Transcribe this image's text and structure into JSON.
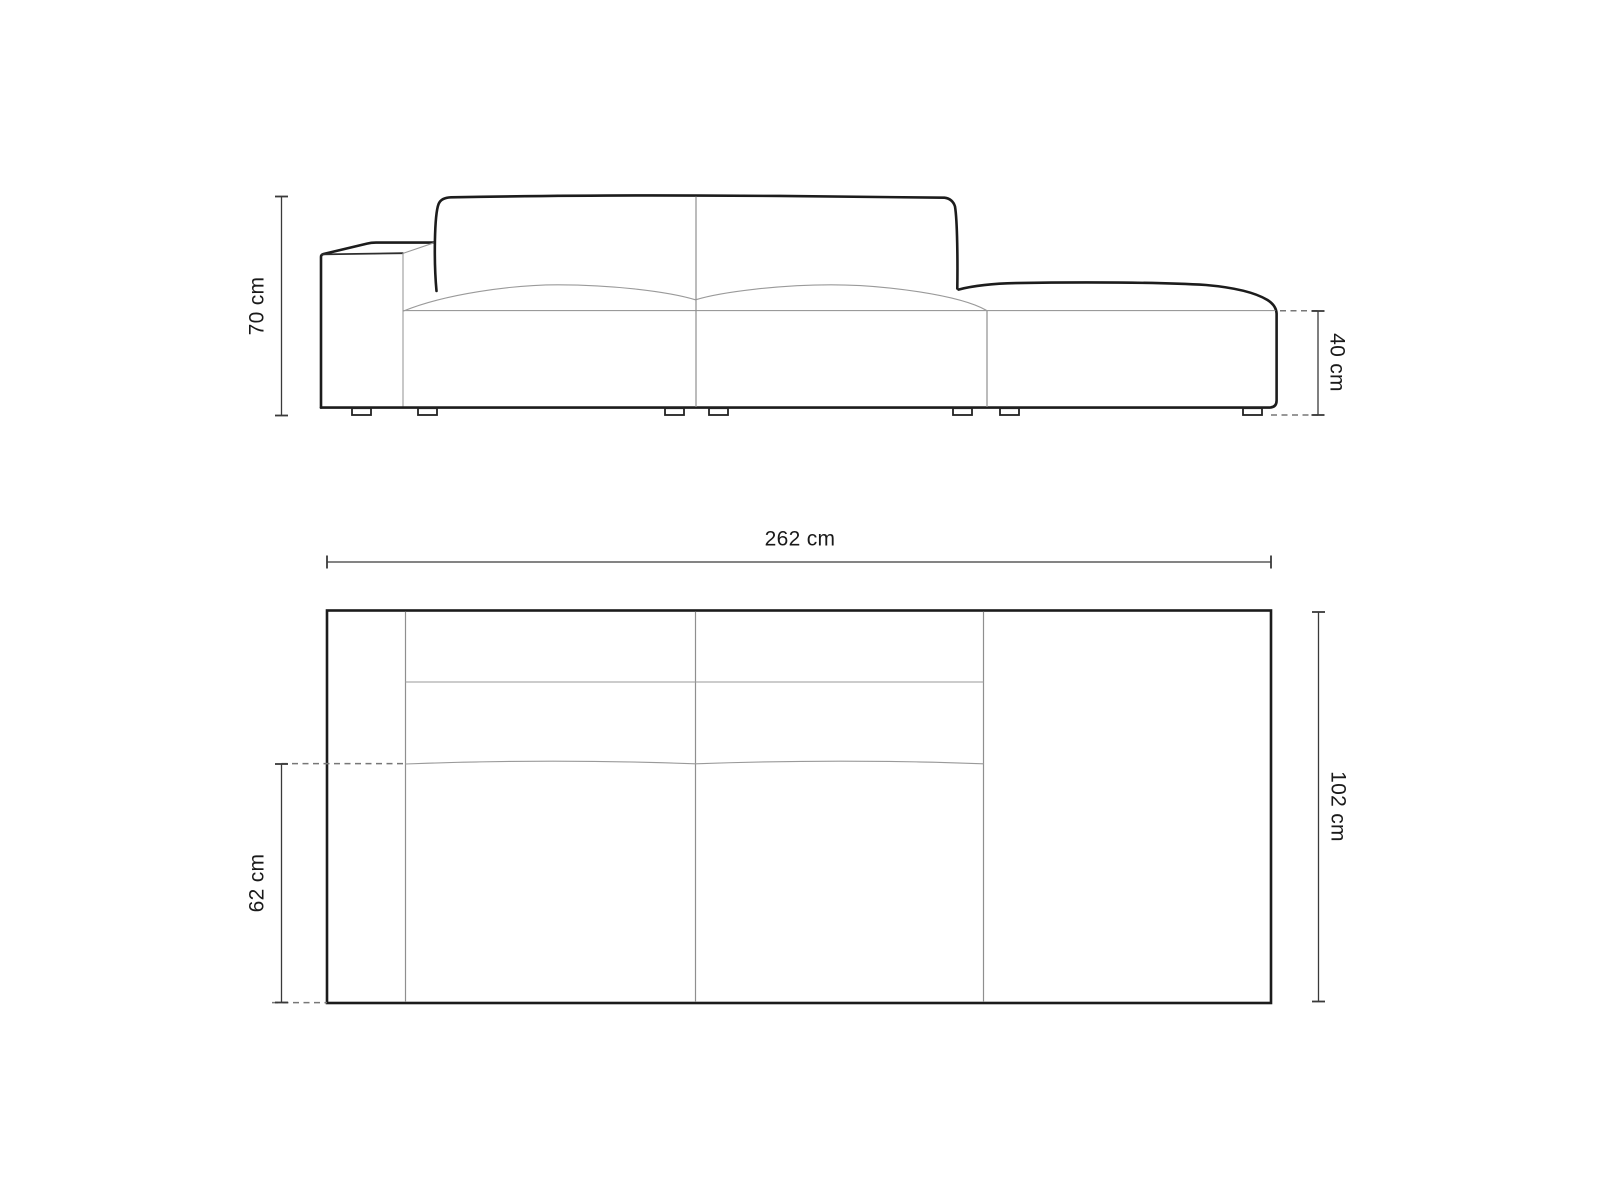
{
  "diagram": {
    "kind": "sofa-dimension-drawing",
    "front_view": {
      "height_label": "70 cm",
      "seat_height_label": "40 cm"
    },
    "top_view": {
      "width_label": "262 cm",
      "depth_label": "102 cm",
      "seat_depth_label": "62 cm"
    }
  },
  "colors": {
    "background": "#ffffff",
    "outline": "#1c1c1c",
    "inner_line": "#9a9a9a",
    "dimension_line": "#3a3a3a",
    "dashed_line": "#777777",
    "text": "#1a1a1a"
  }
}
